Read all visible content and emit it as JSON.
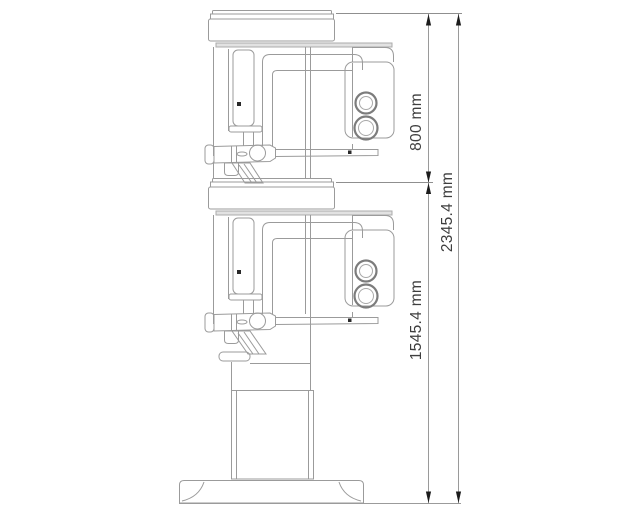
{
  "dimensions": {
    "d800": {
      "label": "800 mm"
    },
    "d2345": {
      "label": "2345.4 mm"
    },
    "d1545": {
      "label": "1545.4 mm"
    }
  },
  "colors": {
    "machine_outline": "#9b9b9b",
    "machine_dark_accent": "#7c7c7c",
    "top_strip_fill": "#e2e2e2",
    "dimension_line": "#8f8f8f",
    "arrow": "#1c1c1c",
    "label_text": "#3e3e3e",
    "background": "#ffffff"
  }
}
